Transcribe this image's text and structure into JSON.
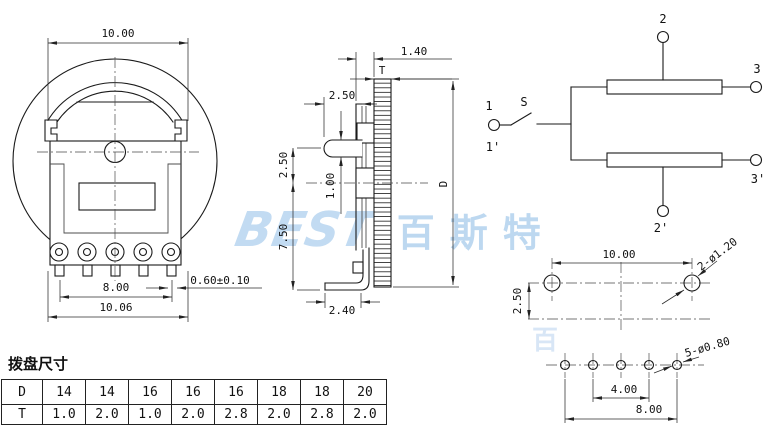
{
  "watermark": {
    "latin": "BEST",
    "cjk": "百斯特",
    "partial": "百"
  },
  "front_view": {
    "dim_width_top": "10.00",
    "dim_pin_span": "8.00",
    "dim_width_bottom": "10.06",
    "dim_pin_width": "0.60±0.10"
  },
  "side_view": {
    "dim_wheel_offset": "1.40",
    "dim_wheel_thickness": "T",
    "dim_lug_length": "2.50",
    "dim_lug_to_center": "2.50",
    "dim_lug_thickness": "1.00",
    "dim_center_to_bottom": "7.50",
    "dim_foot_length": "2.40",
    "dim_wheel_diameter": "D"
  },
  "schematic": {
    "labels": {
      "t1": "1",
      "s": "S",
      "t1p": "1'",
      "t2": "2",
      "t3": "3",
      "t3p": "3'",
      "t2p": "2'"
    }
  },
  "pcb_top": {
    "dim_span": "10.00",
    "dim_offset": "2.50",
    "hole_callout": "2-ø1.20"
  },
  "pcb_bottom": {
    "dim_inner": "4.00",
    "dim_outer": "8.00",
    "hole_callout": "5-ø0.80"
  },
  "table": {
    "title": "拨盘尺寸",
    "rows": [
      {
        "label": "D",
        "values": [
          "14",
          "14",
          "16",
          "16",
          "16",
          "18",
          "18",
          "20"
        ]
      },
      {
        "label": "T",
        "values": [
          "1.0",
          "2.0",
          "1.0",
          "2.0",
          "2.8",
          "2.0",
          "2.8",
          "2.0"
        ]
      }
    ]
  },
  "colors": {
    "line": "#1a1a1a",
    "watermark": "#bcd7ef"
  }
}
